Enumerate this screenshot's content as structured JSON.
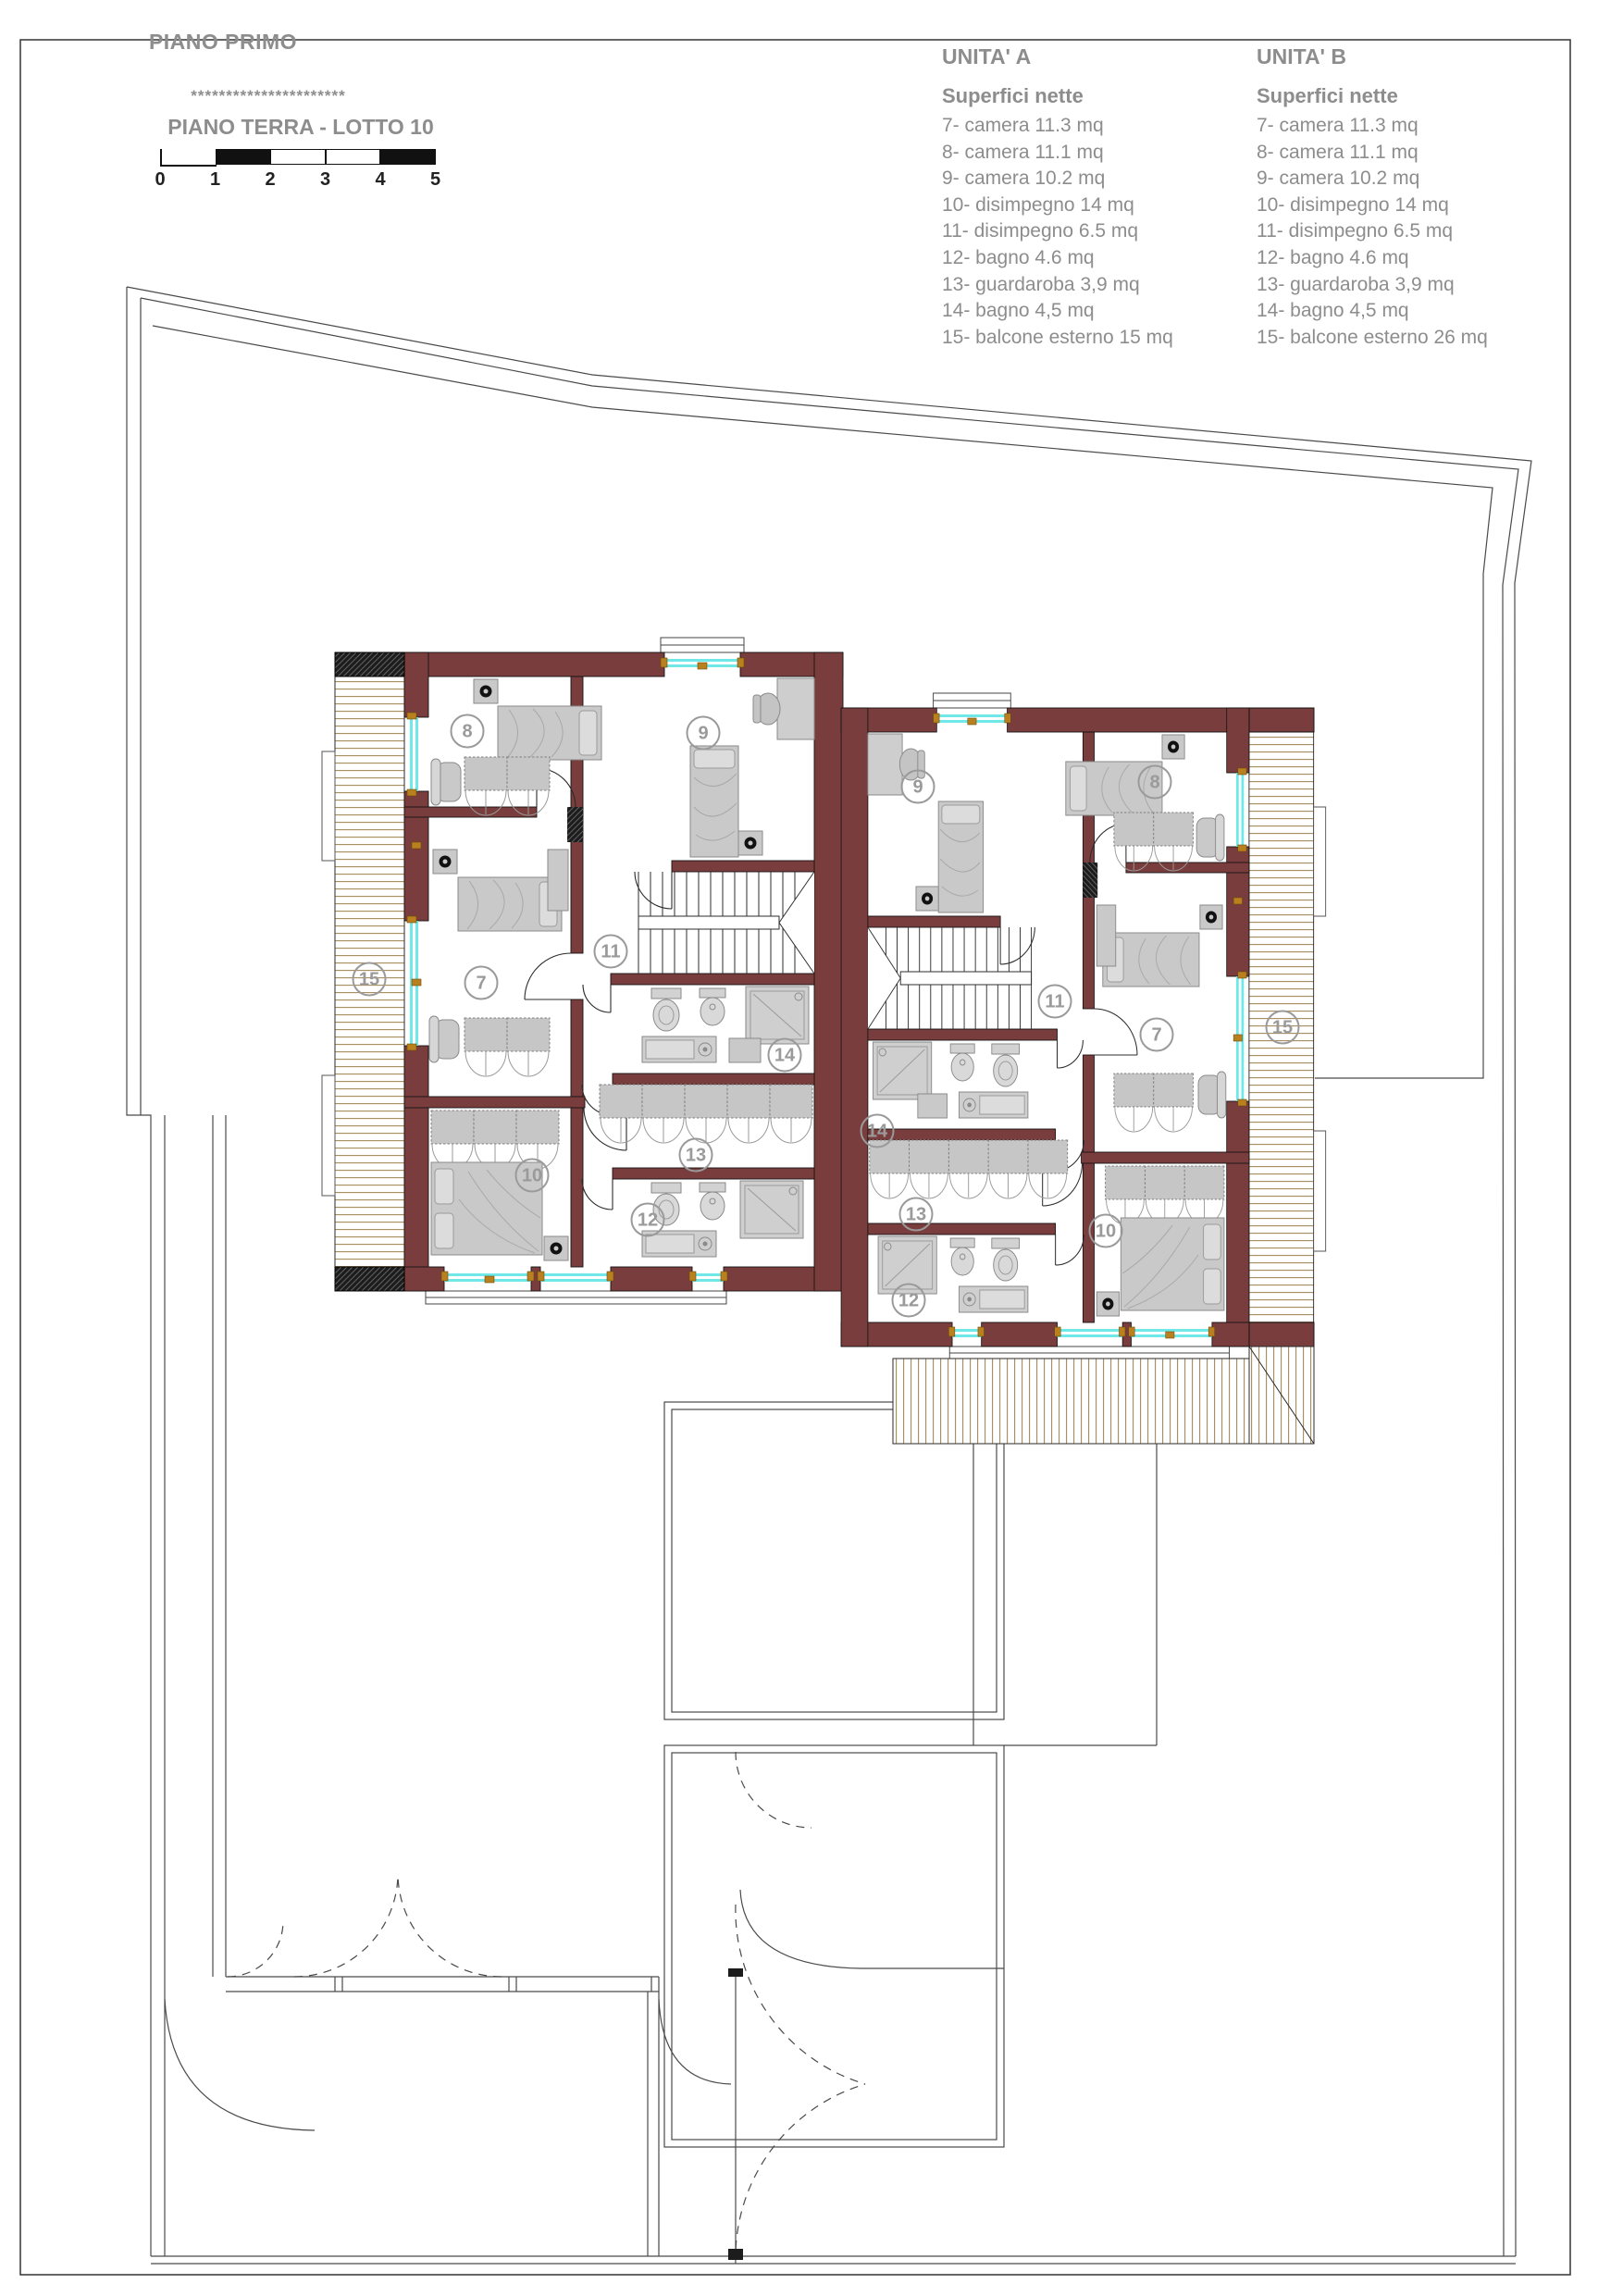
{
  "header": {
    "title": "PIANO PRIMO",
    "stars": "**********************",
    "subtitle": "PIANO TERRA - LOTTO 10"
  },
  "scale_bar": {
    "ticks": [
      "0",
      "1",
      "2",
      "3",
      "4",
      "5"
    ]
  },
  "legend_a": {
    "title": "UNITA' A",
    "subtitle": "Superfici nette",
    "items": [
      "7- camera 11.3 mq",
      "8- camera 11.1 mq",
      "9- camera 10.2 mq",
      "10- disimpegno 14 mq",
      "11- disimpegno 6.5 mq",
      "12- bagno 4.6 mq",
      "13- guardaroba 3,9 mq",
      "14- bagno 4,5 mq",
      "15- balcone esterno 15 mq"
    ]
  },
  "legend_b": {
    "title": "UNITA' B",
    "subtitle": "Superfici nette",
    "items": [
      "7- camera 11.3 mq",
      "8- camera 11.1 mq",
      "9- camera 10.2 mq",
      "10- disimpegno 14 mq",
      "11- disimpegno 6.5 mq",
      "12- bagno 4.6 mq",
      "13- guardaroba 3,9 mq",
      "14- bagno 4,5 mq",
      "15- balcone esterno 26 mq"
    ]
  },
  "plan": {
    "labels": {
      "a7": "7",
      "a8": "8",
      "a9": "9",
      "a10": "10",
      "a11": "11",
      "a12": "12",
      "a13": "13",
      "a14": "14",
      "a15": "15",
      "b7": "7",
      "b8": "8",
      "b9": "9",
      "b10": "10",
      "b11": "11",
      "b12": "12",
      "b13": "13",
      "b14": "14",
      "b15": "15"
    }
  },
  "colors": {
    "wall": "#7a3d3d",
    "glass": "#70e8e8",
    "frame": "#b8801e",
    "deck": "#a38a5c",
    "label": "#9a9a9a",
    "text": "#8d8d8d"
  }
}
